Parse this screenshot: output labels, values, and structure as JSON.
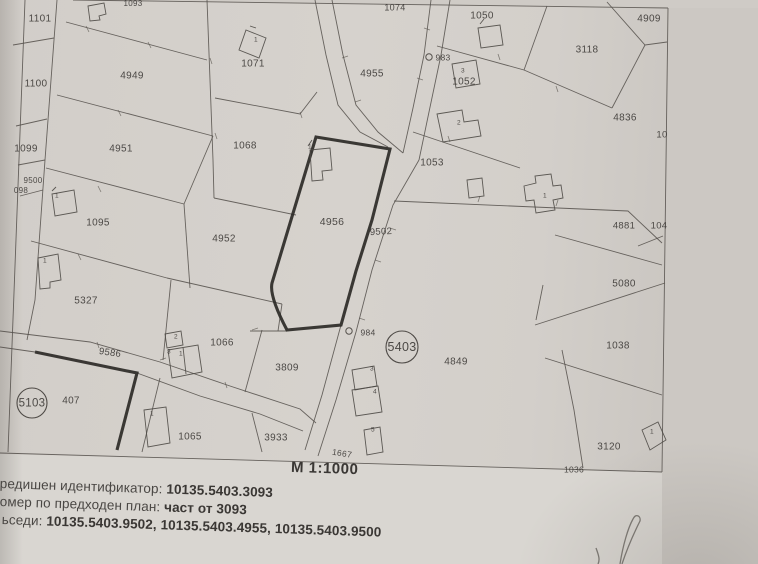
{
  "map": {
    "scale_label": "М 1:1000",
    "quarter_circles": [
      {
        "t": "5403",
        "x": 402,
        "y": 347,
        "rr": 16,
        "s": 12.5
      },
      {
        "t": "5103",
        "x": 32,
        "y": 403,
        "rr": 15,
        "s": 11.5
      }
    ],
    "point_markers": [
      {
        "t": "983",
        "x": 429,
        "y": 57,
        "tx": 443,
        "ty": 58
      },
      {
        "t": "984",
        "x": 349,
        "y": 331,
        "tx": 368,
        "ty": 333
      }
    ],
    "labels": [
      {
        "t": "1101",
        "x": 40,
        "y": 19,
        "s": 10,
        "k": "parcel"
      },
      {
        "t": "1100",
        "x": 36,
        "y": 84,
        "s": 10,
        "k": "parcel"
      },
      {
        "t": "1099",
        "x": 26,
        "y": 149,
        "s": 10,
        "k": "parcel"
      },
      {
        "t": "9500",
        "x": 33,
        "y": 181,
        "s": 8,
        "k": "parcel"
      },
      {
        "t": "098",
        "x": 21,
        "y": 191,
        "s": 8,
        "k": "parcel"
      },
      {
        "t": "4949",
        "x": 132,
        "y": 76,
        "s": 10,
        "k": "parcel"
      },
      {
        "t": "4951",
        "x": 121,
        "y": 149,
        "s": 10,
        "k": "parcel"
      },
      {
        "t": "1095",
        "x": 98,
        "y": 223,
        "s": 10,
        "k": "parcel"
      },
      {
        "t": "5327",
        "x": 86,
        "y": 301,
        "s": 10,
        "k": "parcel"
      },
      {
        "t": "1093",
        "x": 133,
        "y": 4,
        "s": 8,
        "k": "parcel"
      },
      {
        "t": "1071",
        "x": 253,
        "y": 64,
        "s": 10,
        "k": "parcel"
      },
      {
        "t": "1068",
        "x": 245,
        "y": 146,
        "s": 10,
        "k": "parcel"
      },
      {
        "t": "4952",
        "x": 224,
        "y": 239,
        "s": 10,
        "k": "parcel"
      },
      {
        "t": "4956",
        "x": 332,
        "y": 222,
        "s": 10.5,
        "k": "parcel"
      },
      {
        "t": "1074",
        "x": 395,
        "y": 8,
        "s": 9,
        "k": "parcel"
      },
      {
        "t": "4955",
        "x": 372,
        "y": 74,
        "s": 10,
        "k": "parcel"
      },
      {
        "t": "1050",
        "x": 482,
        "y": 16,
        "s": 10,
        "k": "parcel"
      },
      {
        "t": "4909",
        "x": 649,
        "y": 19,
        "s": 10,
        "k": "parcel"
      },
      {
        "t": "3118",
        "x": 587,
        "y": 50,
        "s": 10,
        "k": "parcel"
      },
      {
        "t": "1052",
        "x": 464,
        "y": 82,
        "s": 10,
        "k": "parcel"
      },
      {
        "t": "4836",
        "x": 625,
        "y": 118,
        "s": 10,
        "k": "parcel"
      },
      {
        "t": "10",
        "x": 662,
        "y": 135,
        "s": 9.5,
        "k": "parcel"
      },
      {
        "t": "1053",
        "x": 432,
        "y": 163,
        "s": 10,
        "k": "parcel"
      },
      {
        "t": "4881",
        "x": 624,
        "y": 226,
        "s": 9.5,
        "k": "parcel"
      },
      {
        "t": "104",
        "x": 659,
        "y": 226,
        "s": 9.5,
        "k": "parcel"
      },
      {
        "t": "5080",
        "x": 624,
        "y": 284,
        "s": 10,
        "k": "parcel"
      },
      {
        "t": "9502",
        "x": 381,
        "y": 232,
        "s": 9.5,
        "r": -3,
        "k": "road"
      },
      {
        "t": "1038",
        "x": 618,
        "y": 346,
        "s": 10,
        "k": "parcel"
      },
      {
        "t": "4849",
        "x": 456,
        "y": 362,
        "s": 10,
        "k": "parcel"
      },
      {
        "t": "3120",
        "x": 609,
        "y": 447,
        "s": 10,
        "k": "parcel"
      },
      {
        "t": "1036",
        "x": 574,
        "y": 470,
        "s": 8.5,
        "k": "parcel"
      },
      {
        "t": "1066",
        "x": 222,
        "y": 343,
        "s": 10,
        "k": "parcel"
      },
      {
        "t": "9586",
        "x": 110,
        "y": 353,
        "s": 9.5,
        "r": 8,
        "k": "road"
      },
      {
        "t": "407",
        "x": 71,
        "y": 401,
        "s": 10,
        "k": "parcel"
      },
      {
        "t": "1065",
        "x": 190,
        "y": 437,
        "s": 10,
        "k": "parcel"
      },
      {
        "t": "3809",
        "x": 287,
        "y": 368,
        "s": 10,
        "k": "parcel"
      },
      {
        "t": "3933",
        "x": 276,
        "y": 438,
        "s": 10,
        "k": "parcel"
      },
      {
        "t": "1667",
        "x": 342,
        "y": 454,
        "s": 8.5,
        "r": 9,
        "k": "road"
      },
      {
        "t": "1",
        "x": 256,
        "y": 40,
        "s": 6.5,
        "k": "building"
      },
      {
        "t": "1",
        "x": 57,
        "y": 196,
        "s": 6.5,
        "k": "building"
      },
      {
        "t": "1",
        "x": 45,
        "y": 261,
        "s": 6.5,
        "k": "building"
      },
      {
        "t": "3",
        "x": 463,
        "y": 71,
        "s": 6.5,
        "k": "building"
      },
      {
        "t": "2",
        "x": 459,
        "y": 123,
        "s": 6.5,
        "k": "building"
      },
      {
        "t": "1",
        "x": 545,
        "y": 196,
        "s": 6.5,
        "k": "building"
      },
      {
        "t": "1",
        "x": 310,
        "y": 147,
        "s": 6.5,
        "k": "building"
      },
      {
        "t": "2",
        "x": 176,
        "y": 337,
        "s": 6.5,
        "k": "building"
      },
      {
        "t": "3",
        "x": 169,
        "y": 352,
        "s": 6.5,
        "k": "building"
      },
      {
        "t": "1",
        "x": 181,
        "y": 354,
        "s": 6.5,
        "k": "building"
      },
      {
        "t": "1",
        "x": 152,
        "y": 414,
        "s": 6.5,
        "k": "building"
      },
      {
        "t": "3",
        "x": 372,
        "y": 369,
        "s": 6.5,
        "k": "building"
      },
      {
        "t": "4",
        "x": 375,
        "y": 392,
        "s": 6.5,
        "k": "building"
      },
      {
        "t": "5",
        "x": 373,
        "y": 430,
        "s": 6.5,
        "k": "building"
      },
      {
        "t": "1",
        "x": 652,
        "y": 432,
        "s": 6.5,
        "k": "building"
      }
    ]
  },
  "footer": {
    "items": [
      {
        "label": "редишен идентификатор: ",
        "value": "10135.5403.3093"
      },
      {
        "label": "омер по предходен план: ",
        "value": "част от 3093"
      },
      {
        "label": "ьседи: ",
        "value": "10135.5403.9502, 10135.5403.4955, 10135.5403.9500"
      }
    ]
  }
}
